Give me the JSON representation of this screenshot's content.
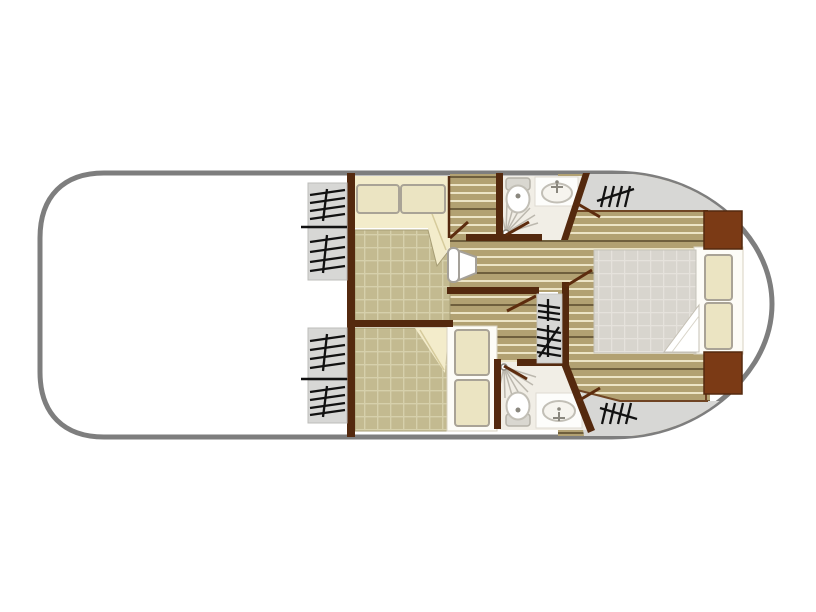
{
  "figure": {
    "kind": "boat-floor-plan",
    "orientation": "bow-right",
    "visible_text": []
  },
  "colors": {
    "hull_stroke": "#7e7e7e",
    "hull_fill": "#ffffff",
    "wall": "#54290e",
    "wall_light": "#6f4423",
    "wardrobe": "#7b3a15",
    "deck": "#d7d7d5",
    "deck_border": "#bcbcba",
    "plank_base": "#b2a172",
    "plank_line": "#ece4c6",
    "plank_dark": "#6f5f3d",
    "blanket": "#c3ba90",
    "blanket_line": "#d6d0ab",
    "blanket_edge": "#a79d74",
    "sheet": "#f3eccb",
    "sheet_line": "#d6cb9c",
    "pillow": "#ebe4c2",
    "pillow_stroke": "#a9a396",
    "mattress": "#d8d5ce",
    "mattress_line": "#e5e2dc",
    "platform": "#fdfcf7",
    "platform_stroke": "#d8d2c2",
    "bath_floor": "#f1eee6",
    "fixture_stroke": "#c2bfb6",
    "fixture_fill": "#ffffff",
    "fixture_detail": "#8a877e",
    "spray": "#bcb8ae",
    "door": "#5d2c0e",
    "glyph": "#111111"
  },
  "rooms": [
    {
      "name": "open-bow-deck"
    },
    {
      "name": "forward-double-cabin-top"
    },
    {
      "name": "forward-double-cabin-bottom"
    },
    {
      "name": "bathroom-top"
    },
    {
      "name": "bathroom-bottom"
    },
    {
      "name": "central-corridor"
    },
    {
      "name": "aft-double-cabin"
    },
    {
      "name": "aft-deck-top"
    },
    {
      "name": "aft-deck-bottom"
    }
  ],
  "icons": [
    {
      "name": "steps-tally-icon",
      "count": 8
    },
    {
      "name": "toilet-icon",
      "count": 2
    },
    {
      "name": "washbasin-icon",
      "count": 2
    },
    {
      "name": "shower-spray-icon",
      "count": 2
    },
    {
      "name": "door-leaf-icon",
      "count": 7
    },
    {
      "name": "bed-double-icon",
      "count": 3
    },
    {
      "name": "pillow-icon",
      "count": 6
    },
    {
      "name": "wardrobe-block-icon",
      "count": 2
    }
  ]
}
